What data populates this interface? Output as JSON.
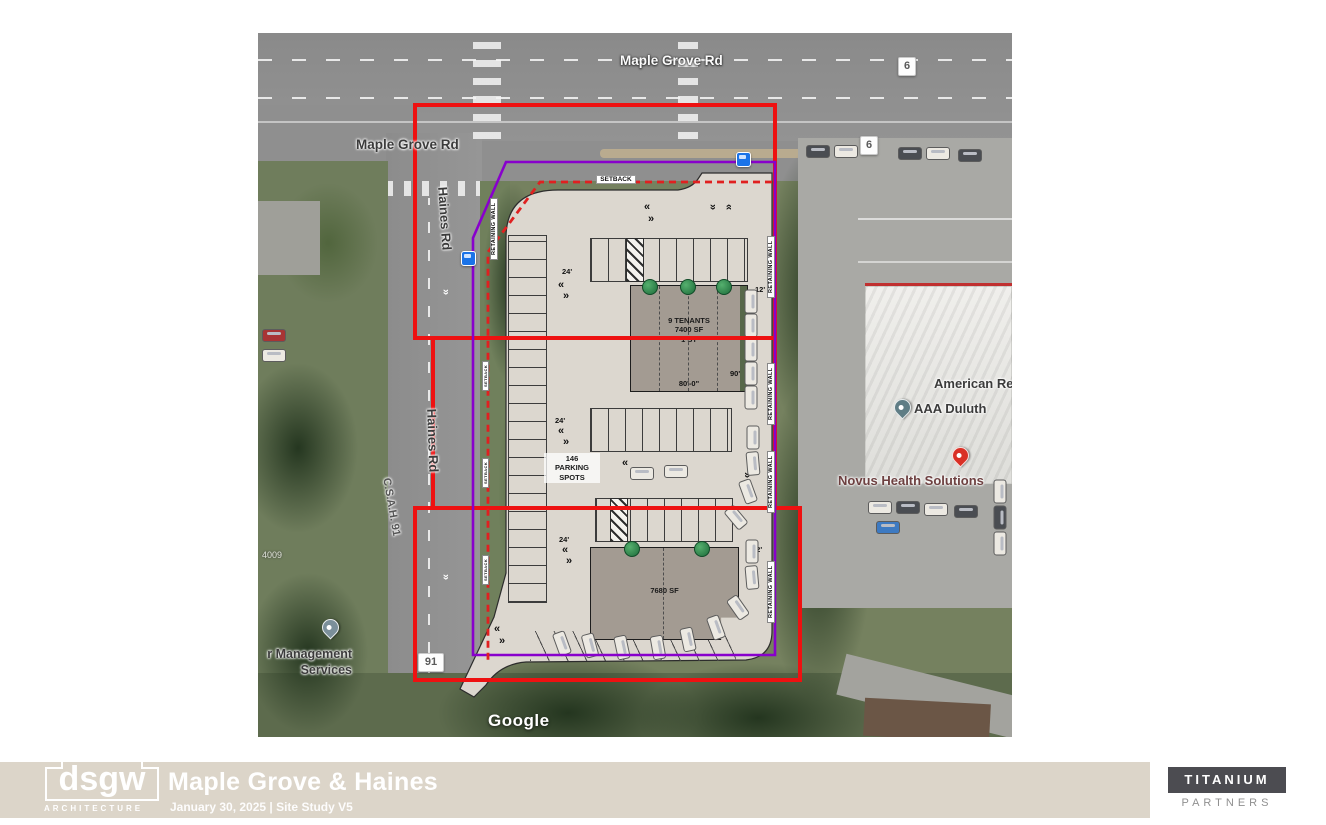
{
  "footer": {
    "logo_text": "dsgw",
    "logo_tagline": "ARCHITECTURE",
    "title": "Maple Grove & Haines",
    "subtitle": "January 30, 2025  |  Site Study V5",
    "partner_line1": "TITANIUM",
    "partner_line2": "PARTNERS"
  },
  "map": {
    "road_labels": {
      "maple_top": "Maple Grove Rd",
      "maple_west": "Maple Grove Rd",
      "haines_n": "Haines Rd",
      "haines_s": "Haines Rd",
      "csah": "C.S.A.H. 91"
    },
    "shields": {
      "route6": "6",
      "route91": "91"
    },
    "address": "4009",
    "watermark": "Google",
    "pois": {
      "aaa": "AAA Duluth",
      "american": "American Re",
      "novus": "Novus Health Solutions",
      "mgmt_line1": "r Management",
      "mgmt_line2": "Services"
    }
  },
  "plan": {
    "north_building": {
      "line1": "9 TENANTS",
      "line2": "7400 SF",
      "line3": "1 ST",
      "width_dim": "80'-0\"",
      "depth_dim": "90'"
    },
    "south_building": {
      "area": "7680 SF",
      "side_dim": "12'"
    },
    "parking_count": {
      "line1": "146",
      "line2": "PARKING",
      "line3": "SPOTS"
    },
    "aisle_dims": {
      "d24": "24'",
      "d12": "12'"
    },
    "retaining_wall_label": "RETAINING WALL",
    "setback_label": "SETBACK",
    "arrow_left": "«",
    "arrow_right": "»"
  },
  "colors": {
    "parcel_red": "#ee1111",
    "site_purple": "#8800cc",
    "setback_dashed_red": "#e02020",
    "bus_blue": "#1a73e8",
    "titanium_box": "#4c4c51"
  }
}
